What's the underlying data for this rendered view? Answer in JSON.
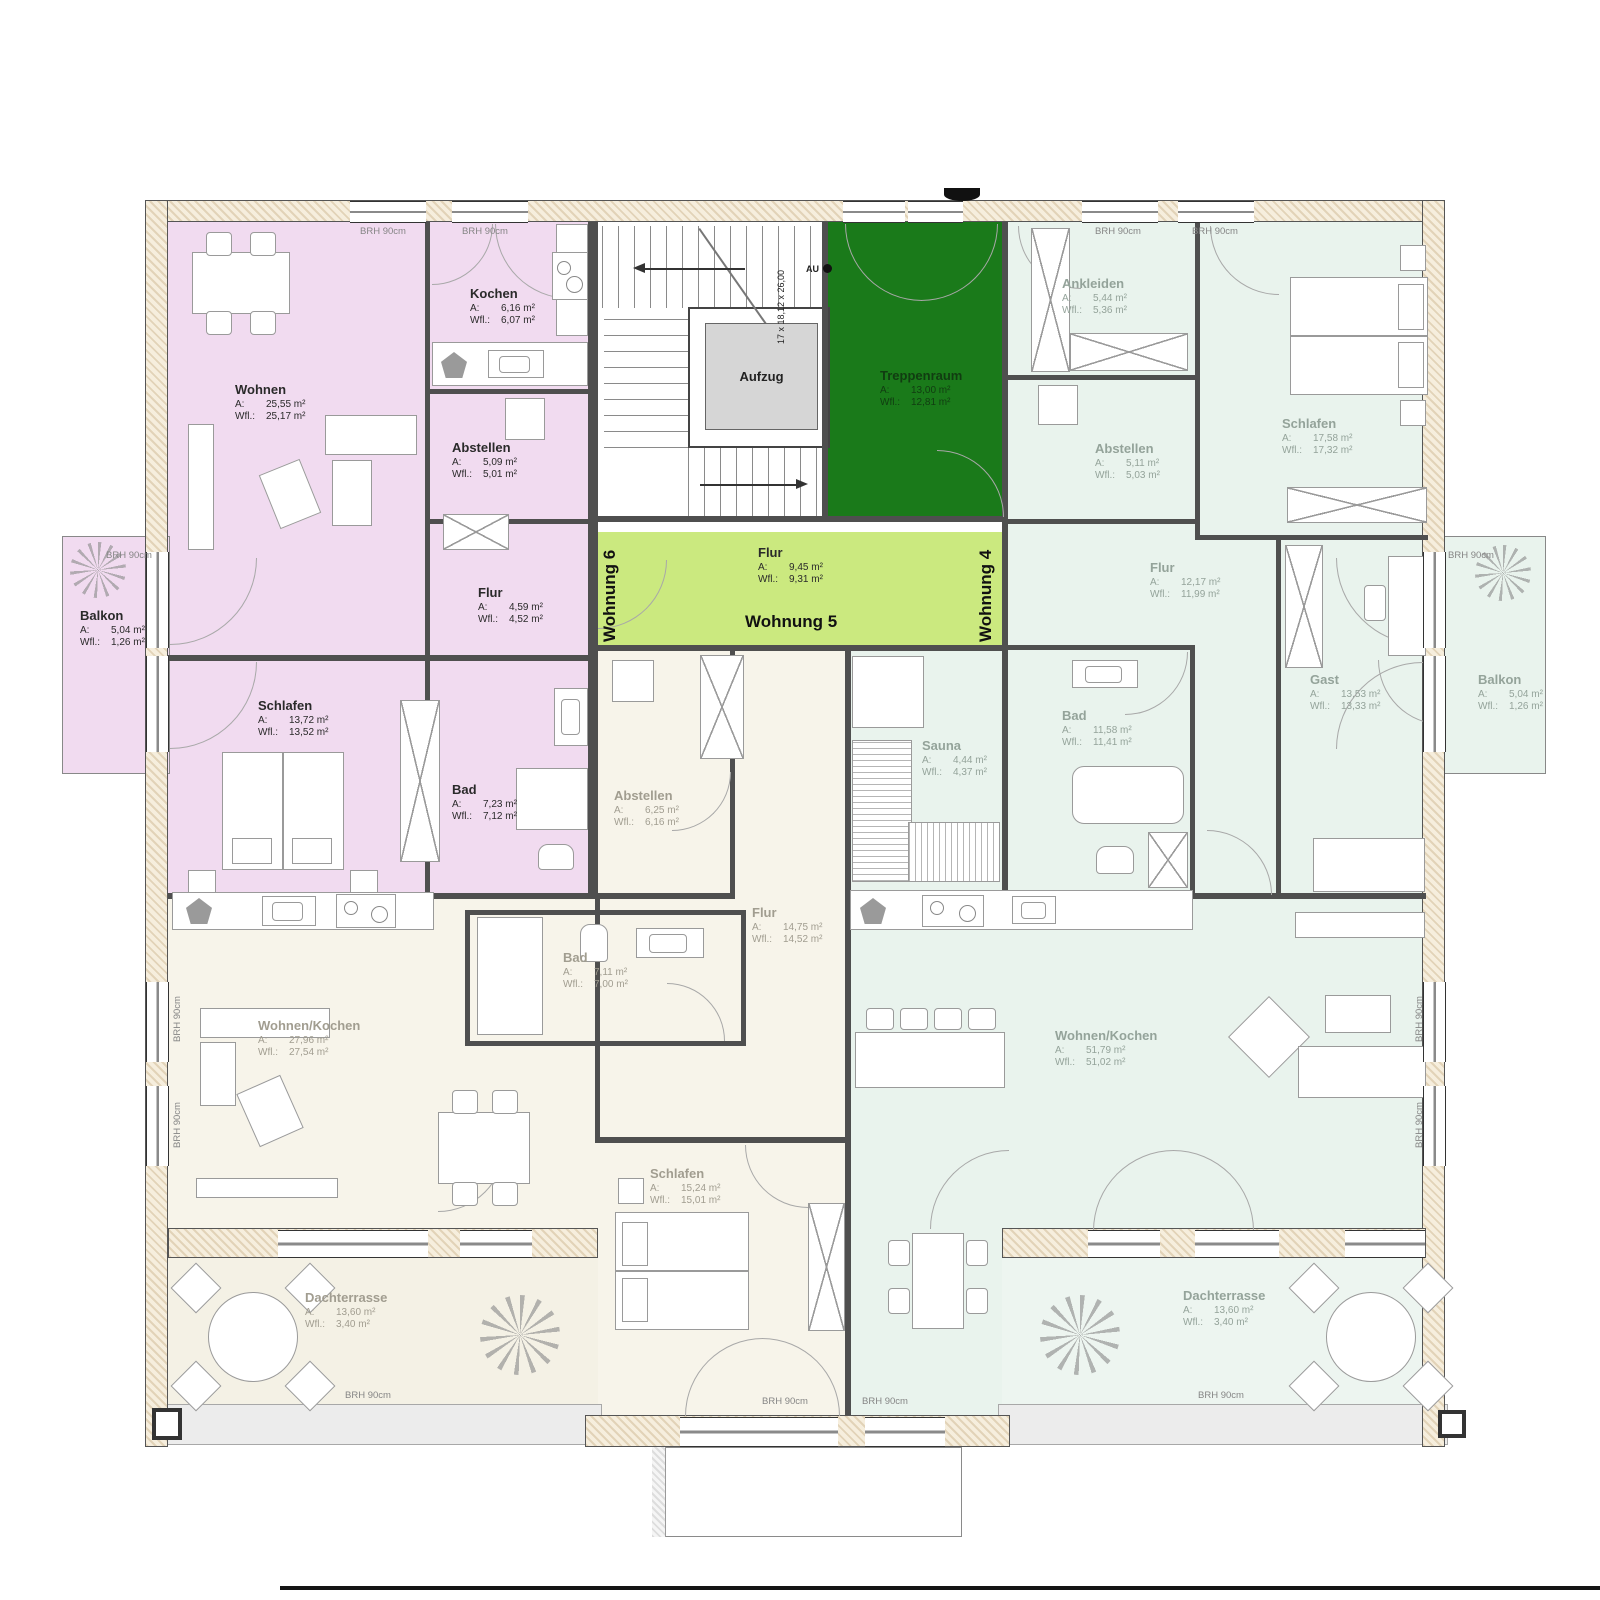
{
  "labels": {
    "a": "A:",
    "wfl": "Wfl.:",
    "brh": "BRH 90cm"
  },
  "units": {
    "w4": "Wohnung 4",
    "w5": "Wohnung 5",
    "w6": "Wohnung 6"
  },
  "core": {
    "aufzug": "Aufzug",
    "treppenraum": {
      "name": "Treppenraum",
      "area": "13,00 m²",
      "wfl": "12,81 m²"
    },
    "flur": {
      "name": "Flur",
      "area": "9,45 m²",
      "wfl": "9,31 m²"
    },
    "stair_dim": "17 x 18,12 x 26,00",
    "stair_mark": "AU"
  },
  "w6": {
    "wohnen": {
      "name": "Wohnen",
      "area": "25,55 m²",
      "wfl": "25,17 m²"
    },
    "kochen": {
      "name": "Kochen",
      "area": "6,16 m²",
      "wfl": "6,07 m²"
    },
    "abstellen": {
      "name": "Abstellen",
      "area": "5,09 m²",
      "wfl": "5,01 m²"
    },
    "flur": {
      "name": "Flur",
      "area": "4,59 m²",
      "wfl": "4,52 m²"
    },
    "schlafen": {
      "name": "Schlafen",
      "area": "13,72 m²",
      "wfl": "13,52 m²"
    },
    "bad": {
      "name": "Bad",
      "area": "7,23 m²",
      "wfl": "7,12 m²"
    },
    "balkon": {
      "name": "Balkon",
      "area": "5,04 m²",
      "wfl": "1,26 m²"
    }
  },
  "w5": {
    "abstellen": {
      "name": "Abstellen",
      "area": "6,25 m²",
      "wfl": "6,16 m²"
    },
    "flur": {
      "name": "Flur",
      "area": "14,75 m²",
      "wfl": "14,52 m²"
    },
    "bad": {
      "name": "Bad",
      "area": "7,11 m²",
      "wfl": "7,00 m²"
    },
    "wohnen_kochen": {
      "name": "Wohnen/Kochen",
      "area": "27,96 m²",
      "wfl": "27,54 m²"
    },
    "schlafen": {
      "name": "Schlafen",
      "area": "15,24 m²",
      "wfl": "15,01 m²"
    },
    "dachterrasse": {
      "name": "Dachterrasse",
      "area": "13,60 m²",
      "wfl": "3,40 m²"
    }
  },
  "w4": {
    "ankleiden": {
      "name": "Ankleiden",
      "area": "5,44 m²",
      "wfl": "5,36 m²"
    },
    "abstellen": {
      "name": "Abstellen",
      "area": "5,11 m²",
      "wfl": "5,03 m²"
    },
    "schlafen": {
      "name": "Schlafen",
      "area": "17,58 m²",
      "wfl": "17,32 m²"
    },
    "flur": {
      "name": "Flur",
      "area": "12,17 m²",
      "wfl": "11,99 m²"
    },
    "gast": {
      "name": "Gast",
      "area": "13,53 m²",
      "wfl": "13,33 m²"
    },
    "bad": {
      "name": "Bad",
      "area": "11,58 m²",
      "wfl": "11,41 m²"
    },
    "sauna": {
      "name": "Sauna",
      "area": "4,44 m²",
      "wfl": "4,37 m²"
    },
    "wohnen_kochen": {
      "name": "Wohnen/Kochen",
      "area": "51,79 m²",
      "wfl": "51,02 m²"
    },
    "dachterrasse": {
      "name": "Dachterrasse",
      "area": "13,60 m²",
      "wfl": "3,40 m²"
    },
    "balkon": {
      "name": "Balkon",
      "area": "5,04 m²",
      "wfl": "1,26 m²"
    }
  },
  "colors": {
    "wohnung6_fill": "#f1dbf0",
    "wohnung4_fill": "#e9f3ed",
    "wohnung5_fill": "#f7f4ea",
    "corridor_fill": "#cbe97f",
    "treppenraum_fill": "#1a7a1a",
    "aufzug_fill": "#d6d6d6",
    "wall": "#4f4f4f"
  }
}
